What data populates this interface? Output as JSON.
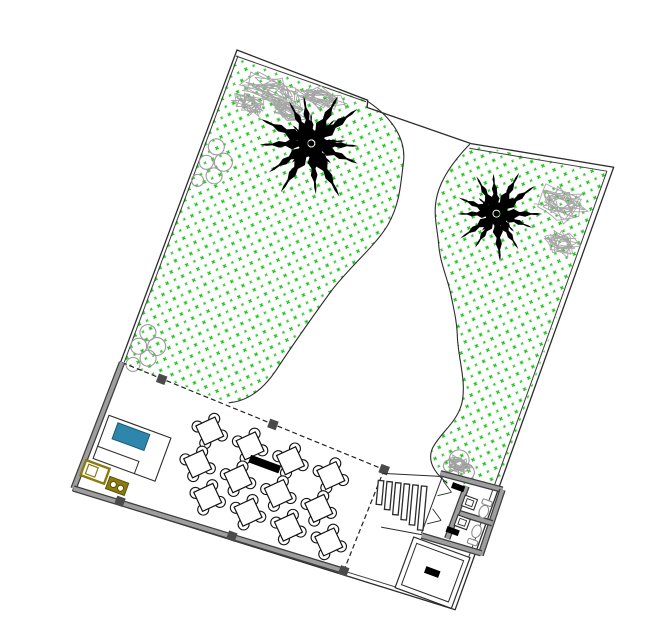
{
  "meta": {
    "title": "Landscape site plan drawing — terrace with tables, two palm trees, planting beds, restrooms and stairs",
    "drawing_type": "CAD site / landscape plan",
    "rotation_deg": 20.2,
    "origin": [
      237,
      50
    ],
    "canvas": [
      649,
      633
    ]
  },
  "colors": {
    "line": "#2b2b2b",
    "inner_line": "#3a3a3a",
    "wall_fill": "#9e9e9e",
    "wall_edge": "#3d3d3d",
    "column": "#4a4a4a",
    "stipple_a": "#14c814",
    "stipple_b": "#2ccc2c",
    "palm": "#000000",
    "shrub_scribble": "#a6a6a6",
    "shrub_circle": "#9a9a9a",
    "counter_blue": "#2e86ad",
    "counter_blue_edge": "#1b5a77",
    "equipment_olive": "#8a7a10",
    "equipment_olive_dark": "#5a4f08",
    "furniture": "#111111",
    "fixture": "#8a8a8a",
    "label_bar": "#000000",
    "dashed_edge": "#222222"
  },
  "boundary": {
    "outer": "M 0,0 L 140,2 L 142,9 L 252,7 L 394,-20 L 398,450 L -2,470 Z",
    "inner_segments": [
      "M 1,6 L 139,4",
      "M 252,12 L 389,-14",
      "M 389,-14 L 393,446",
      "M 393,446 L 282,452",
      "M 3,5 L 2,332"
    ]
  },
  "beds": {
    "left_fill": "M 2,6 L 140,3 C 170,10 190,26 195,48 C 200,70 206,88 202,112 C 197,138 180,165 171,196 C 162,228 154,258 147,288 C 141,312 129,327 114,334 L 2,334 Z",
    "left_curve": "M 140,3 C 170,10 190,26 195,48 C 200,70 206,88 202,112 C 197,138 180,165 171,196 C 162,228 154,258 147,288 C 141,312 129,327 114,334",
    "right_fill": "M 251,8 C 243,26 236,48 238,67 C 240,86 249,97 256,112 C 264,130 277,142 286,157 C 294,170 300,179 305,191 C 313,212 330,231 333,254 C 335,274 323,289 321,306 C 320,321 332,329 347,334 L 395,319 L 390,-13 Z",
    "right_curve": "M 251,8 C 243,26 236,48 238,67 C 240,86 249,97 256,112 C 264,130 277,142 286,157 C 294,170 300,179 305,191 C 313,212 330,231 333,254 C 335,274 323,289 321,306 C 320,321 332,329 347,334",
    "stipple_tile": 12
  },
  "palms": [
    {
      "cx": 102,
      "cy": 62,
      "r": 58
    },
    {
      "cx": 300,
      "cy": 64,
      "r": 48
    }
  ],
  "shrubs": {
    "scribble_clusters": [
      {
        "lobes": [
          [
            52,
            26,
            40,
            18
          ],
          [
            95,
            16,
            28,
            13
          ],
          [
            30,
            46,
            20,
            12
          ],
          [
            68,
            40,
            22,
            10
          ]
        ]
      },
      {
        "lobes": [
          [
            356,
            32,
            30,
            20
          ],
          [
            372,
            70,
            20,
            14
          ]
        ]
      },
      {
        "lobes": [
          [
            352,
            312,
            14,
            10
          ]
        ]
      }
    ],
    "circle_clusters": [
      [
        [
          14,
          98,
          8
        ],
        [
          26,
          110,
          9
        ],
        [
          10,
          116,
          7
        ],
        [
          22,
          126,
          8
        ],
        [
          8,
          136,
          6
        ]
      ],
      [
        [
          14,
          296,
          8
        ],
        [
          27,
          306,
          9
        ],
        [
          10,
          312,
          8
        ],
        [
          23,
          320,
          8
        ],
        [
          11,
          331,
          7
        ]
      ],
      [
        [
          350,
          308,
          10
        ],
        [
          361,
          317,
          8
        ],
        [
          343,
          317,
          6
        ]
      ]
    ]
  },
  "terrace": {
    "dashed_edges": [
      "M 0,333 L 283,343",
      "M 283,343 L 280,452"
    ],
    "walls": [
      [
        0,
        333,
        -2,
        468
      ],
      [
        -2,
        468,
        280,
        452
      ]
    ],
    "columns": [
      [
        43,
        335
      ],
      [
        163,
        339
      ],
      [
        283,
        343
      ],
      [
        46,
        464
      ],
      [
        163,
        458
      ],
      [
        280,
        452
      ]
    ],
    "column_size": 9,
    "label_bar": [
      153,
      375,
      32,
      8
    ]
  },
  "tables": {
    "size": 21,
    "chair_radius": 5.5,
    "chair_offset": 13,
    "positions": [
      [
        106,
        367
      ],
      [
        149,
        367
      ],
      [
        192,
        367
      ],
      [
        235,
        367
      ],
      [
        106,
        402
      ],
      [
        149,
        402
      ],
      [
        192,
        402
      ],
      [
        235,
        402
      ],
      [
        127,
        430
      ],
      [
        170,
        430
      ],
      [
        213,
        430
      ],
      [
        256,
        430
      ]
    ]
  },
  "counter": {
    "outer": [
      6,
      387,
      66,
      46
    ],
    "inner_l": "M 6,420 L 50,420 L 50,433",
    "blue_unit": [
      17,
      391,
      34,
      17
    ],
    "olive_a_outer": [
      0,
      437,
      25,
      16
    ],
    "olive_a_inner": [
      4,
      440,
      10,
      10
    ],
    "olive_b": [
      28,
      444,
      20,
      13
    ],
    "olive_b_circles": [
      [
        34,
        450.5,
        3
      ],
      [
        42,
        451.5,
        3
      ]
    ]
  },
  "stairs": {
    "tread_width": 5.5,
    "tread_cy": 366,
    "tread_rot": -15,
    "treads": [
      [
        287,
        24
      ],
      [
        296,
        28
      ],
      [
        305,
        32
      ],
      [
        314,
        36
      ],
      [
        323,
        40
      ],
      [
        332,
        44
      ]
    ],
    "landing_lines": [
      "M 283,347 L 338,330",
      "M 300,398 L 341,391"
    ]
  },
  "restrooms": {
    "walls": [
      [
        337,
        327,
        401,
        321
      ],
      [
        401,
        321,
        403,
        390
      ],
      [
        341,
        392,
        403,
        388
      ],
      [
        366,
        358,
        403,
        356
      ],
      [
        366,
        330,
        366,
        386
      ]
    ],
    "thin_edge": "M 340,328 L 340,390",
    "door_lines": [
      "M 342,333 L 354,341",
      "M 342,349 L 354,341",
      "M 342,363 L 354,371",
      "M 342,379 L 354,371"
    ],
    "sinks": [
      [
        368,
        339
      ],
      [
        368,
        360
      ]
    ],
    "sink_size": [
      13,
      11
    ],
    "sink_inner": [
      3,
      2.5,
      7,
      6
    ],
    "toilets": [
      {
        "cx": 391,
        "cy": 348,
        "tank": [
          386,
          336
        ]
      },
      {
        "cx": 391,
        "cy": 369,
        "tank": [
          386,
          378
        ]
      }
    ],
    "toilet_rx": 4.5,
    "toilet_ry": 6.5,
    "tank_size": [
      10,
      5
    ],
    "label_bars": [
      [
        352,
        331,
        13,
        6
      ],
      [
        362,
        374,
        13,
        6
      ]
    ]
  },
  "storage_room": {
    "outer": [
      334,
      396,
      60,
      54
    ],
    "inner": [
      339,
      401,
      50,
      44
    ],
    "label_bar": [
      356,
      419,
      15,
      7
    ]
  }
}
